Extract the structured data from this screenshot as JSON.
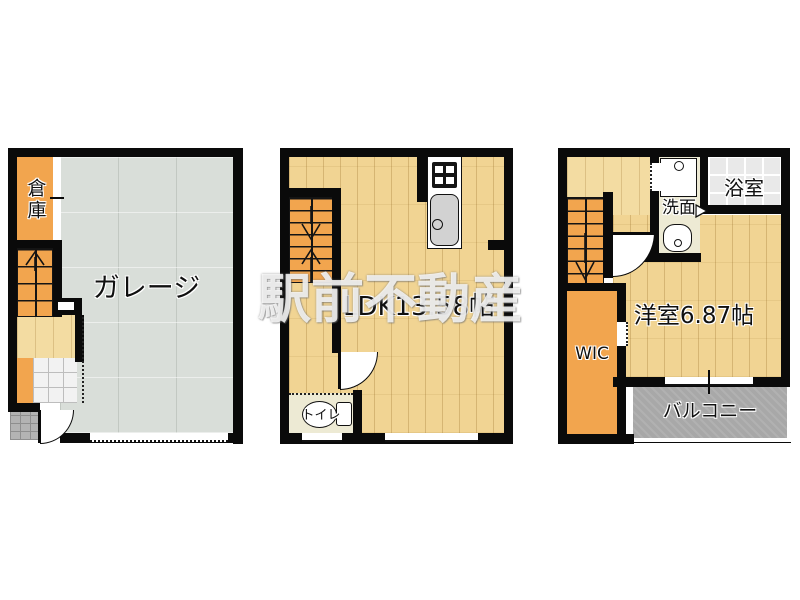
{
  "watermark": {
    "text": "駅前不動産"
  },
  "colors": {
    "wall": "#0a0a0a",
    "orange": "#F2A54E",
    "wood": "#F1D493",
    "wood_light": "#F3DCA2",
    "garage_gray": "#D9DED9",
    "balcony_gray": "#A8A8A8",
    "bath_gray": "#E9E9E9",
    "cream": "#EDEAD4",
    "watermark_color": "rgba(255,255,255,0.82)"
  },
  "floor1": {
    "storage": "倉庫",
    "garage": "ガレージ"
  },
  "floor2": {
    "ldk": "LDK13.58帖",
    "toilet": "トイレ"
  },
  "floor3": {
    "washroom": "洗面",
    "bathroom": "浴室",
    "western_room": "洋室6.87帖",
    "wic": "WIC",
    "balcony": "バルコニー"
  }
}
